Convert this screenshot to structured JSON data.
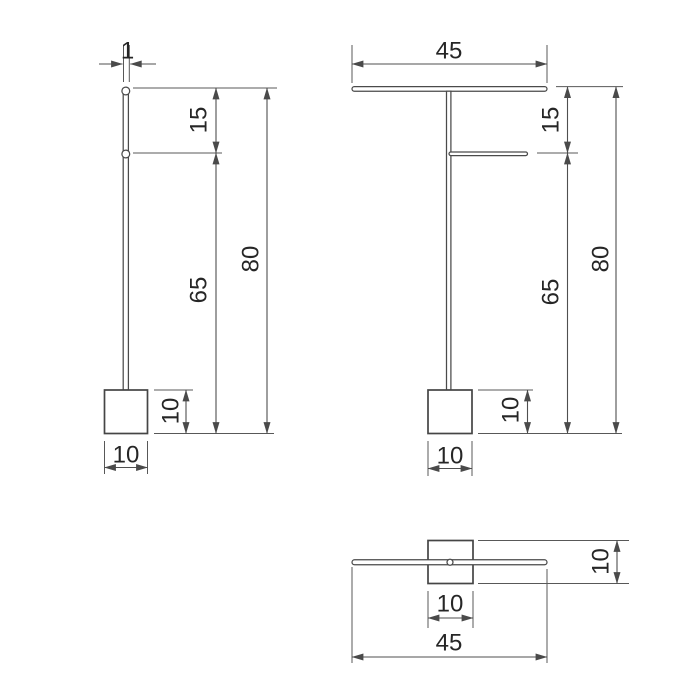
{
  "drawing": {
    "kind": "technical-dimension-drawing",
    "subject": "freestanding towel / toilet-roll stand",
    "colors": {
      "background": "#ffffff",
      "product_line": "#454545",
      "dimension_line": "#4f4f4f",
      "label_text": "#262626"
    },
    "views": {
      "side": {
        "name": "side-view",
        "dims": {
          "pole_diameter": "1",
          "top_gap": "15",
          "pole_height": "65",
          "total_height": "80",
          "base_height": "10",
          "base_width": "10"
        }
      },
      "front": {
        "name": "front-view",
        "dims": {
          "bar_width": "45",
          "top_gap": "15",
          "pole_height": "65",
          "total_height": "80",
          "base_height": "10",
          "base_width": "10"
        }
      },
      "top": {
        "name": "top-view",
        "dims": {
          "base_depth": "10",
          "base_width": "10",
          "bar_length": "45"
        }
      }
    }
  }
}
